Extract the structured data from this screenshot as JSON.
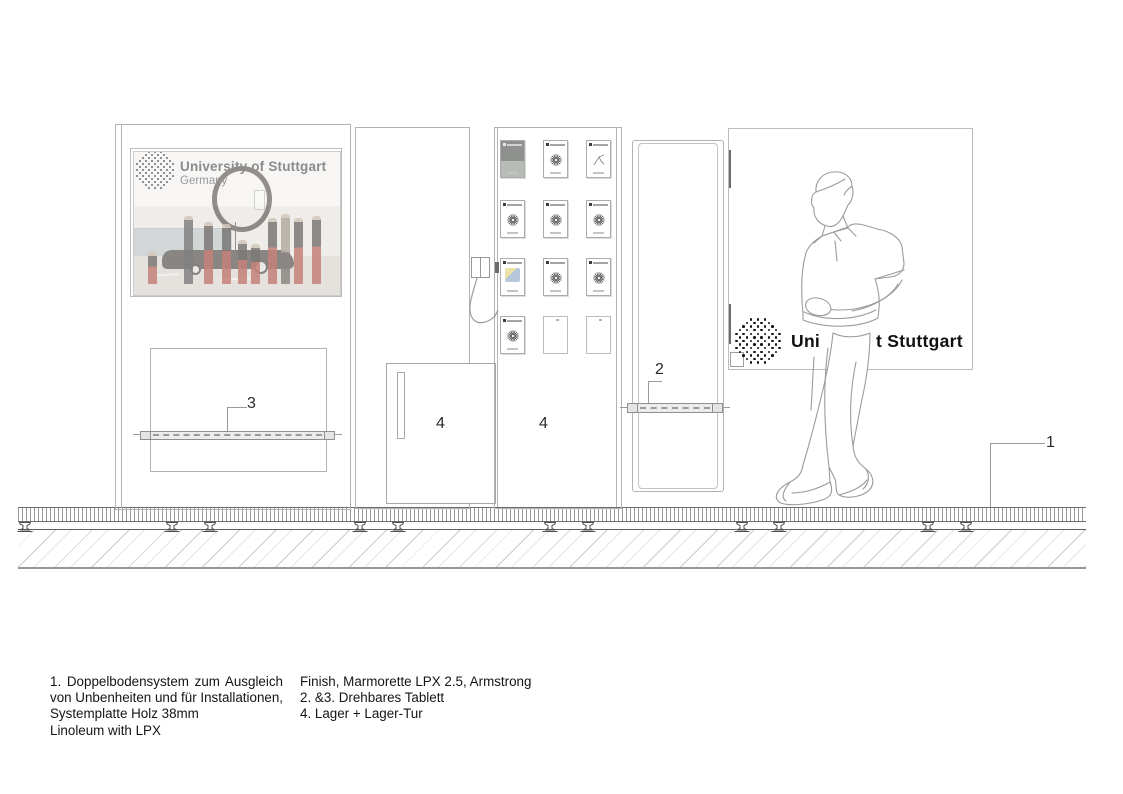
{
  "poster": {
    "brand": "University of Stuttgart",
    "country": "Germany",
    "people": [
      {
        "x": 14,
        "y": 100,
        "h": 32,
        "t": "red"
      },
      {
        "x": 50,
        "y": 64,
        "h": 68,
        "t": "dark"
      },
      {
        "x": 70,
        "y": 70,
        "h": 62,
        "t": "red"
      },
      {
        "x": 88,
        "y": 72,
        "h": 60,
        "t": "red"
      },
      {
        "x": 104,
        "y": 88,
        "h": 44,
        "t": "red"
      },
      {
        "x": 117,
        "y": 92,
        "h": 40,
        "t": "red"
      },
      {
        "x": 134,
        "y": 66,
        "h": 66,
        "t": "red"
      },
      {
        "x": 147,
        "y": 62,
        "h": 70,
        "t": "tan"
      },
      {
        "x": 160,
        "y": 66,
        "h": 66,
        "t": "red"
      },
      {
        "x": 178,
        "y": 64,
        "h": 68,
        "t": "red"
      }
    ]
  },
  "panel_right": {
    "brand_left": "Uni",
    "brand_right": "t Stuttgart"
  },
  "callouts": {
    "c1": "1",
    "c2": "2",
    "c3": "3",
    "c4_door": "4",
    "c4_wall": "4"
  },
  "cards": {
    "cols_x": [
      500,
      543,
      586
    ],
    "rows_y": [
      140,
      200,
      258,
      316
    ],
    "types": [
      [
        "photo",
        "sunburst",
        "sketch"
      ],
      [
        "sunburst",
        "sunburst",
        "sunburst"
      ],
      [
        "chart",
        "sunburst",
        "sunburst"
      ],
      [
        "sunburst",
        "blank",
        "blank"
      ]
    ]
  },
  "floor": {
    "pedestal_x": [
      25,
      172,
      210,
      360,
      398,
      550,
      588,
      742,
      779,
      928,
      966
    ]
  },
  "logos": {
    "poster": {
      "u": 3.0,
      "dot": 2.0,
      "r": 19,
      "color": "#6f6f6f"
    },
    "panel": {
      "u": 3.6,
      "dot": 2.6,
      "r": 25,
      "color": "#171717"
    }
  },
  "notes": {
    "col1": [
      "1. Doppelbodensystem zum Ausgleich",
      "von Unbenheiten und für Installationen,",
      "Systemplatte Holz 38mm",
      "Linoleum with LPX"
    ],
    "col2": [
      "Finish, Marmorette LPX 2.5, Armstrong",
      "2. &3. Drehbares Tablett",
      "4. Lager + Lager-Tur"
    ]
  },
  "colors": {
    "line": "#b3b3b3",
    "line_dark": "#6f6f6f",
    "text": "#141414",
    "suit_red": "#a93a2e"
  }
}
